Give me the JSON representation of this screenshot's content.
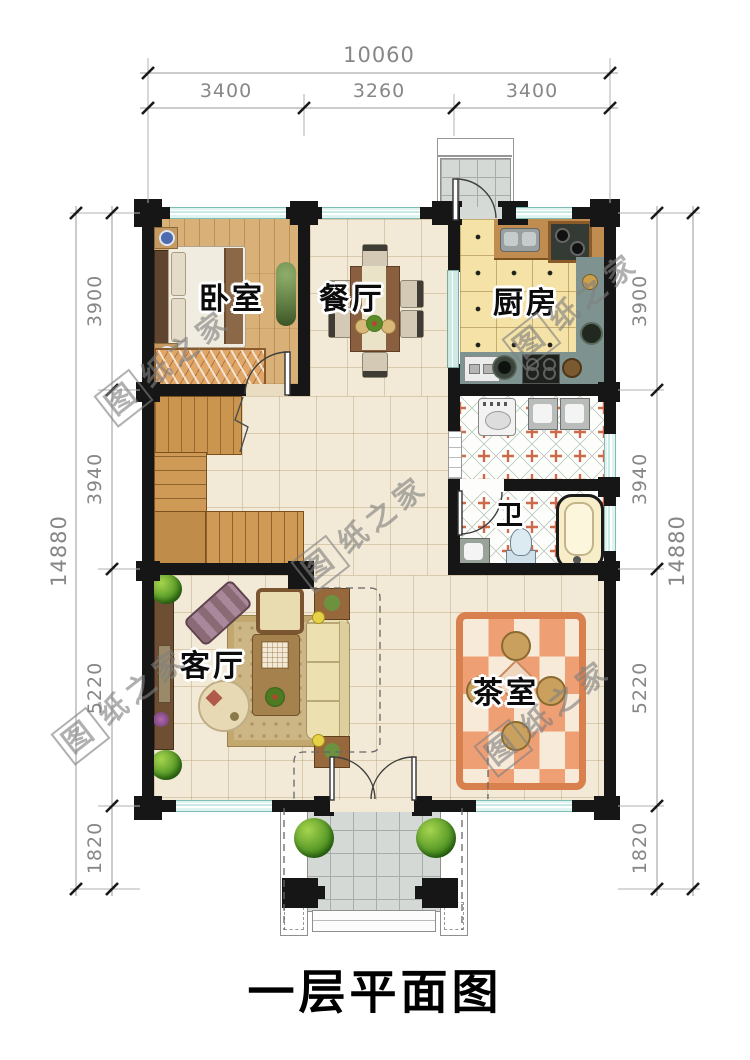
{
  "title": "一层平面图",
  "watermark": {
    "text": "图纸之家"
  },
  "rooms": {
    "bedroom": "卧室",
    "dining": "餐厅",
    "kitchen": "厨房",
    "bath": "卫",
    "living": "客厅",
    "tea": "茶室"
  },
  "dimensions": {
    "top": {
      "total": "10060",
      "segments": [
        "3400",
        "3260",
        "3400"
      ]
    },
    "left": {
      "total": "14880",
      "segments": [
        "3900",
        "3940",
        "5220",
        "1820"
      ]
    },
    "right": {
      "total": "14880",
      "segments": [
        "3900",
        "3940",
        "5220",
        "1820"
      ]
    }
  },
  "colors": {
    "wall": "#161616",
    "window": "#c9eae5",
    "floor_tile": "#f2e9d6",
    "bedroom_wood": "#d9b077",
    "kitchen_tile": "#f4e2a6",
    "bath_cross": "#cd6a4c",
    "tea_rug": "#ef9f74",
    "dimension_text": "#878787"
  }
}
